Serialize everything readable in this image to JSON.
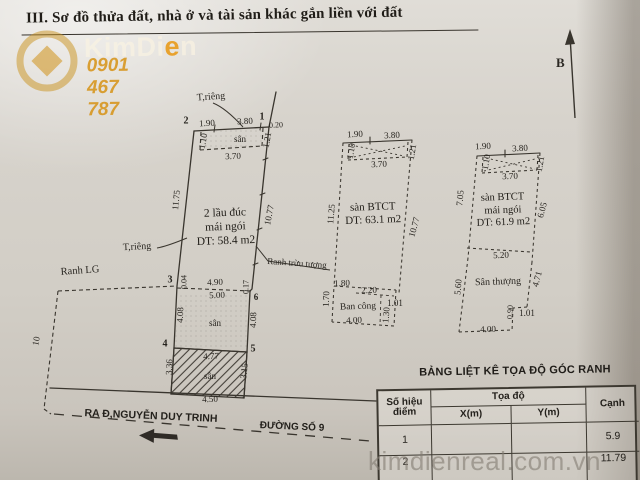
{
  "page": {
    "title": "III. Sơ đồ thửa đất, nhà ở và tài sản khác gắn liền với đất",
    "north_label": "B",
    "watermark": "kimdienreal.com.vn"
  },
  "logo": {
    "part1": "KimDi",
    "accent": "e",
    "part2": "n",
    "phone": "0901 467 787"
  },
  "labels": {
    "trieng_top": "T,riêng",
    "trieng_left": "T,riêng",
    "ranh_lg": "Ranh LG",
    "ranh_truu_tuong": "Ranh trừu tượng",
    "road_main": "RA Đ,NGUYỄN DUY TRINH",
    "road_secondary": "ĐƯỜNG SỐ 9",
    "san_thuong": "Sân thượng",
    "ban_cong": "Ban công"
  },
  "plots": {
    "left": {
      "line1": "2 lầu đúc",
      "line2": "mái ngói",
      "line3": "DT: 58.4 m2"
    },
    "middle": {
      "line1": "sàn BTCT",
      "line2": "DT: 63.1 m2"
    },
    "right": {
      "line1": "sàn BTCT",
      "line2": "mái ngói",
      "line3": "DT: 61.9 m2"
    }
  },
  "measurements": [
    {
      "t": "1.90",
      "x": 207,
      "y": 123,
      "r": -3
    },
    {
      "t": "3.80",
      "x": 245,
      "y": 121,
      "r": -3
    },
    {
      "t": "0.20",
      "x": 276,
      "y": 125,
      "r": -3,
      "s": 8
    },
    {
      "t": "sân",
      "x": 240,
      "y": 139
    },
    {
      "t": "1.10",
      "x": 203,
      "y": 141,
      "r": -80
    },
    {
      "t": "1.21",
      "x": 267,
      "y": 140,
      "r": -80
    },
    {
      "t": "3.70",
      "x": 233,
      "y": 156,
      "r": -2
    },
    {
      "t": "11.75",
      "x": 176,
      "y": 200,
      "r": -84
    },
    {
      "t": "10.77",
      "x": 269,
      "y": 215,
      "r": -79
    },
    {
      "t": "0.04",
      "x": 184,
      "y": 282,
      "r": -90,
      "s": 8
    },
    {
      "t": "4.90",
      "x": 215,
      "y": 282,
      "r": -2
    },
    {
      "t": "5.00",
      "x": 217,
      "y": 295,
      "r": -2
    },
    {
      "t": "0.17",
      "x": 246,
      "y": 287,
      "r": -90,
      "s": 8
    },
    {
      "t": "4.08",
      "x": 180,
      "y": 315,
      "r": -88
    },
    {
      "t": "4.08",
      "x": 253,
      "y": 320,
      "r": -88
    },
    {
      "t": "sân",
      "x": 215,
      "y": 323
    },
    {
      "t": "4.77",
      "x": 211,
      "y": 356,
      "r": -2
    },
    {
      "t": "sân",
      "x": 210,
      "y": 376
    },
    {
      "t": "3.36",
      "x": 169,
      "y": 367,
      "r": -88
    },
    {
      "t": "3.15",
      "x": 244,
      "y": 371,
      "r": -84
    },
    {
      "t": "4.50",
      "x": 210,
      "y": 399,
      "r": -2
    },
    {
      "t": "10",
      "x": 36,
      "y": 341,
      "r": -80
    },
    {
      "t": "2",
      "x": 186,
      "y": 121,
      "b": 1,
      "s": 10,
      "n": "point-number"
    },
    {
      "t": "1",
      "x": 262,
      "y": 117,
      "b": 1,
      "s": 10,
      "n": "point-number"
    },
    {
      "t": "3",
      "x": 170,
      "y": 280,
      "b": 1,
      "s": 10,
      "n": "point-number"
    },
    {
      "t": "4",
      "x": 165,
      "y": 344,
      "b": 1,
      "s": 10,
      "n": "point-number"
    },
    {
      "t": "5",
      "x": 253,
      "y": 349,
      "b": 1,
      "s": 10,
      "n": "point-number"
    },
    {
      "t": "6",
      "x": 256,
      "y": 297,
      "b": 1,
      "s": 9,
      "n": "point-number"
    },
    {
      "t": "1.90",
      "x": 355,
      "y": 134,
      "r": -3
    },
    {
      "t": "3.80",
      "x": 392,
      "y": 135,
      "r": -3
    },
    {
      "t": "1.10",
      "x": 351,
      "y": 151,
      "r": -80
    },
    {
      "t": "1.21",
      "x": 412,
      "y": 152,
      "r": -80
    },
    {
      "t": "3.70",
      "x": 379,
      "y": 164,
      "r": -2
    },
    {
      "t": "11.25",
      "x": 331,
      "y": 214,
      "r": -85
    },
    {
      "t": "10.77",
      "x": 414,
      "y": 227,
      "r": -75
    },
    {
      "t": "1.80",
      "x": 342,
      "y": 283,
      "r": -2
    },
    {
      "t": "2.20",
      "x": 369,
      "y": 290,
      "r": -2
    },
    {
      "t": "1.70",
      "x": 326,
      "y": 299,
      "r": -88
    },
    {
      "t": "1.01",
      "x": 395,
      "y": 303
    },
    {
      "t": "1.30",
      "x": 386,
      "y": 315,
      "r": -85
    },
    {
      "t": "4.00",
      "x": 354,
      "y": 320,
      "r": -2
    },
    {
      "t": "1.90",
      "x": 483,
      "y": 146,
      "r": -3
    },
    {
      "t": "3.80",
      "x": 520,
      "y": 148,
      "r": -3
    },
    {
      "t": "1.10",
      "x": 486,
      "y": 162,
      "r": -80
    },
    {
      "t": "1.21",
      "x": 540,
      "y": 164,
      "r": -80
    },
    {
      "t": "3.70",
      "x": 510,
      "y": 176,
      "r": -2
    },
    {
      "t": "7.05",
      "x": 460,
      "y": 198,
      "r": -85
    },
    {
      "t": "6.05",
      "x": 542,
      "y": 210,
      "r": -75
    },
    {
      "t": "5.20",
      "x": 501,
      "y": 255,
      "r": -2
    },
    {
      "t": "5.60",
      "x": 458,
      "y": 287,
      "r": -85
    },
    {
      "t": "4.71",
      "x": 537,
      "y": 279,
      "r": -75
    },
    {
      "t": "0.90",
      "x": 510,
      "y": 312,
      "r": -88,
      "s": 8
    },
    {
      "t": "1.01",
      "x": 527,
      "y": 313
    },
    {
      "t": "4.00",
      "x": 488,
      "y": 329,
      "r": -2
    }
  ],
  "table": {
    "title": "BẢNG LIỆT KÊ TỌA ĐỘ GÓC RANH",
    "headers": {
      "point": "Số hiệu điểm",
      "coords": "Tọa độ",
      "x": "X(m)",
      "y": "Y(m)",
      "edge": "Cạnh"
    },
    "rows": [
      {
        "point": "1",
        "x": "",
        "y": "",
        "edge": "5.9"
      },
      {
        "point": "2",
        "x": "",
        "y": "",
        "edge": "11.79"
      }
    ]
  },
  "colors": {
    "ink": "#39352e",
    "gold": "#cf9118",
    "watermark_gray": "#827c72"
  }
}
